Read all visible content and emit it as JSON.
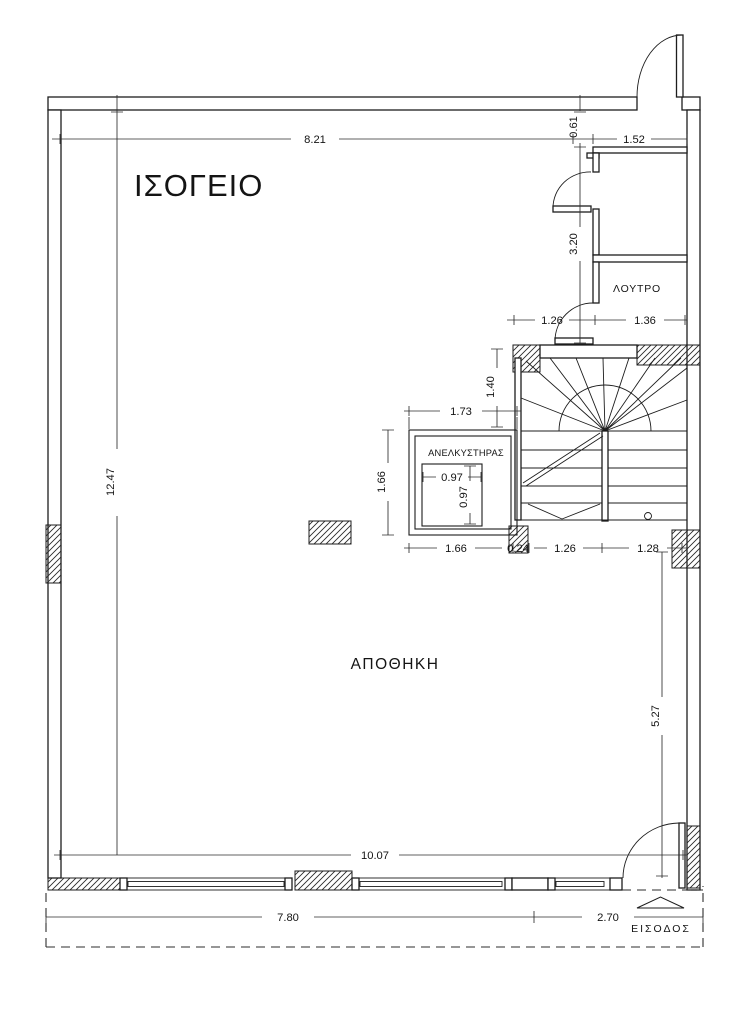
{
  "plan": {
    "title": "ΙΣΟΓΕΙΟ",
    "rooms": {
      "storage": "ΑΠΟΘΗΚΗ",
      "bathroom": "ΛΟΥΤΡΟ",
      "elevator": "ΑΝΕΛΚΥΣΤΗΡΑΣ",
      "entrance": "ΕΙΣΟΔΟΣ"
    },
    "dims": {
      "top_width": "8.21",
      "recess_height": "0.61",
      "top_right_width": "1.52",
      "hall_height": "3.20",
      "landing_width": "1.26",
      "bathroom_width": "1.36",
      "lobby_depth": "1.40",
      "shaft_width": "1.73",
      "shaft_depth": "1.66",
      "cab_width": "0.97",
      "cab_depth": "0.97",
      "shaft_bottom_width": "1.66",
      "wall_gap": "0.24",
      "stair_left_width": "1.26",
      "stair_right_width": "1.28",
      "interior_height": "12.47",
      "right_lower_height": "5.27",
      "shopfront_width": "10.07",
      "plot_front_left": "7.80",
      "plot_front_right": "2.70"
    },
    "colors": {
      "line": "#1d1d1d",
      "dim_line": "#2e2e2e",
      "background": "#ffffff"
    }
  }
}
